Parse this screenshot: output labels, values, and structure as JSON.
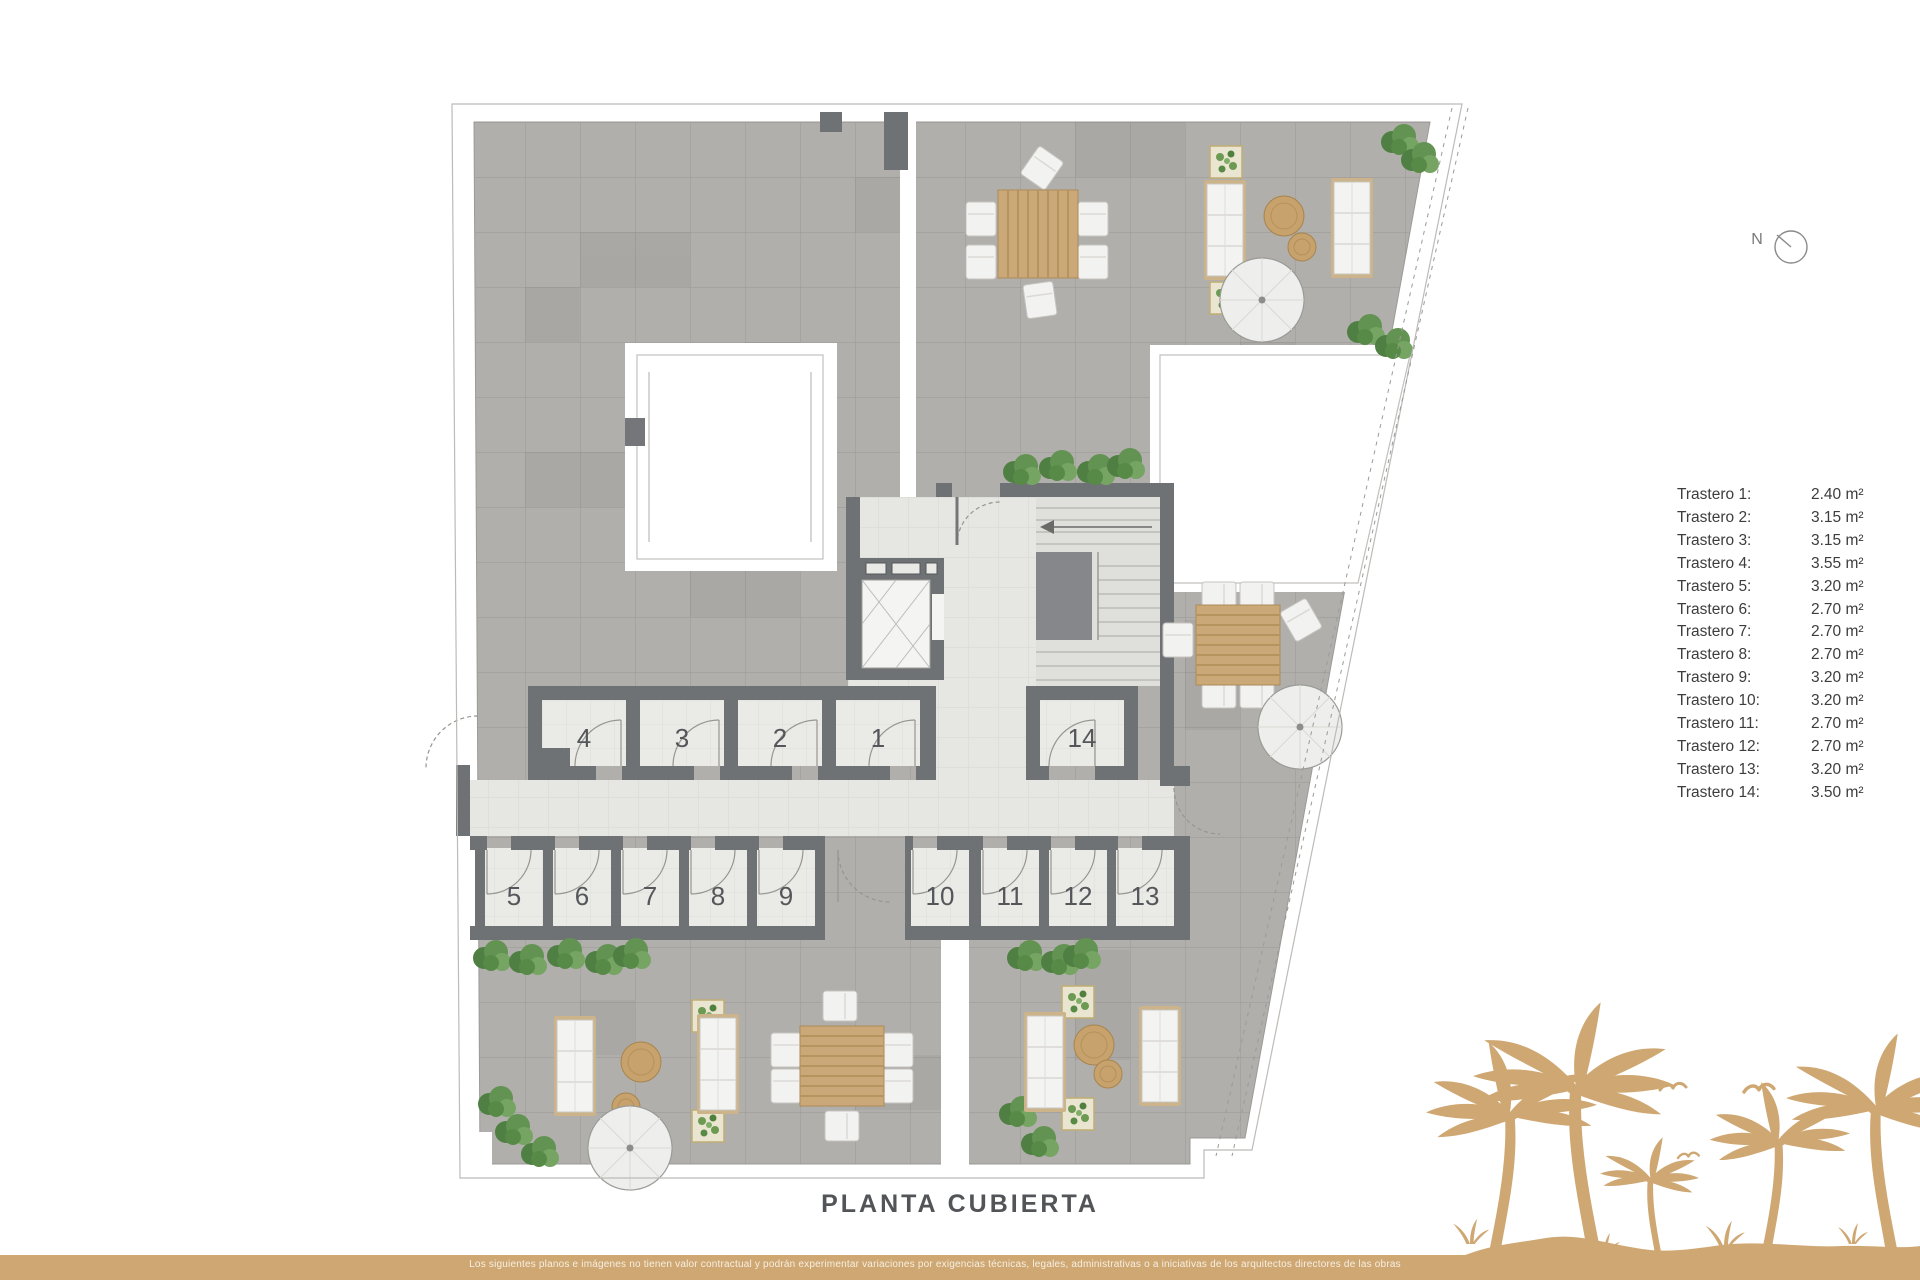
{
  "plan": {
    "title": "PLANTA CUBIERTA",
    "compass_label": "N",
    "room_numbers": [
      "1",
      "2",
      "3",
      "4",
      "5",
      "6",
      "7",
      "8",
      "9",
      "10",
      "11",
      "12",
      "13",
      "14"
    ]
  },
  "legend": {
    "items": [
      {
        "label": "Trastero 1:",
        "value": "2.40 m²"
      },
      {
        "label": "Trastero 2:",
        "value": "3.15 m²"
      },
      {
        "label": "Trastero 3:",
        "value": "3.15 m²"
      },
      {
        "label": "Trastero 4:",
        "value": "3.55 m²"
      },
      {
        "label": "Trastero 5:",
        "value": "3.20 m²"
      },
      {
        "label": "Trastero 6:",
        "value": "2.70 m²"
      },
      {
        "label": "Trastero 7:",
        "value": "2.70 m²"
      },
      {
        "label": "Trastero 8:",
        "value": "2.70 m²"
      },
      {
        "label": "Trastero 9:",
        "value": "3.20 m²"
      },
      {
        "label": "Trastero 10:",
        "value": "3.20 m²"
      },
      {
        "label": "Trastero 11:",
        "value": "2.70 m²"
      },
      {
        "label": "Trastero 12:",
        "value": "2.70 m²"
      },
      {
        "label": "Trastero 13:",
        "value": "3.20 m²"
      },
      {
        "label": "Trastero 14:",
        "value": "3.50 m²"
      }
    ]
  },
  "footer": {
    "disclaimer": "Los siguientes planos e imágenes no tienen valor contractual y podrán experimentar variaciones por exigencias técnicas, legales, administrativas o a iniciativas de los arquitectos directores de las obras"
  },
  "colors": {
    "accent_tan": "#cfa772",
    "terrace_gray": "#b1afab",
    "wall_gray": "#6f7275",
    "legend_text": "#3d3d3d"
  }
}
